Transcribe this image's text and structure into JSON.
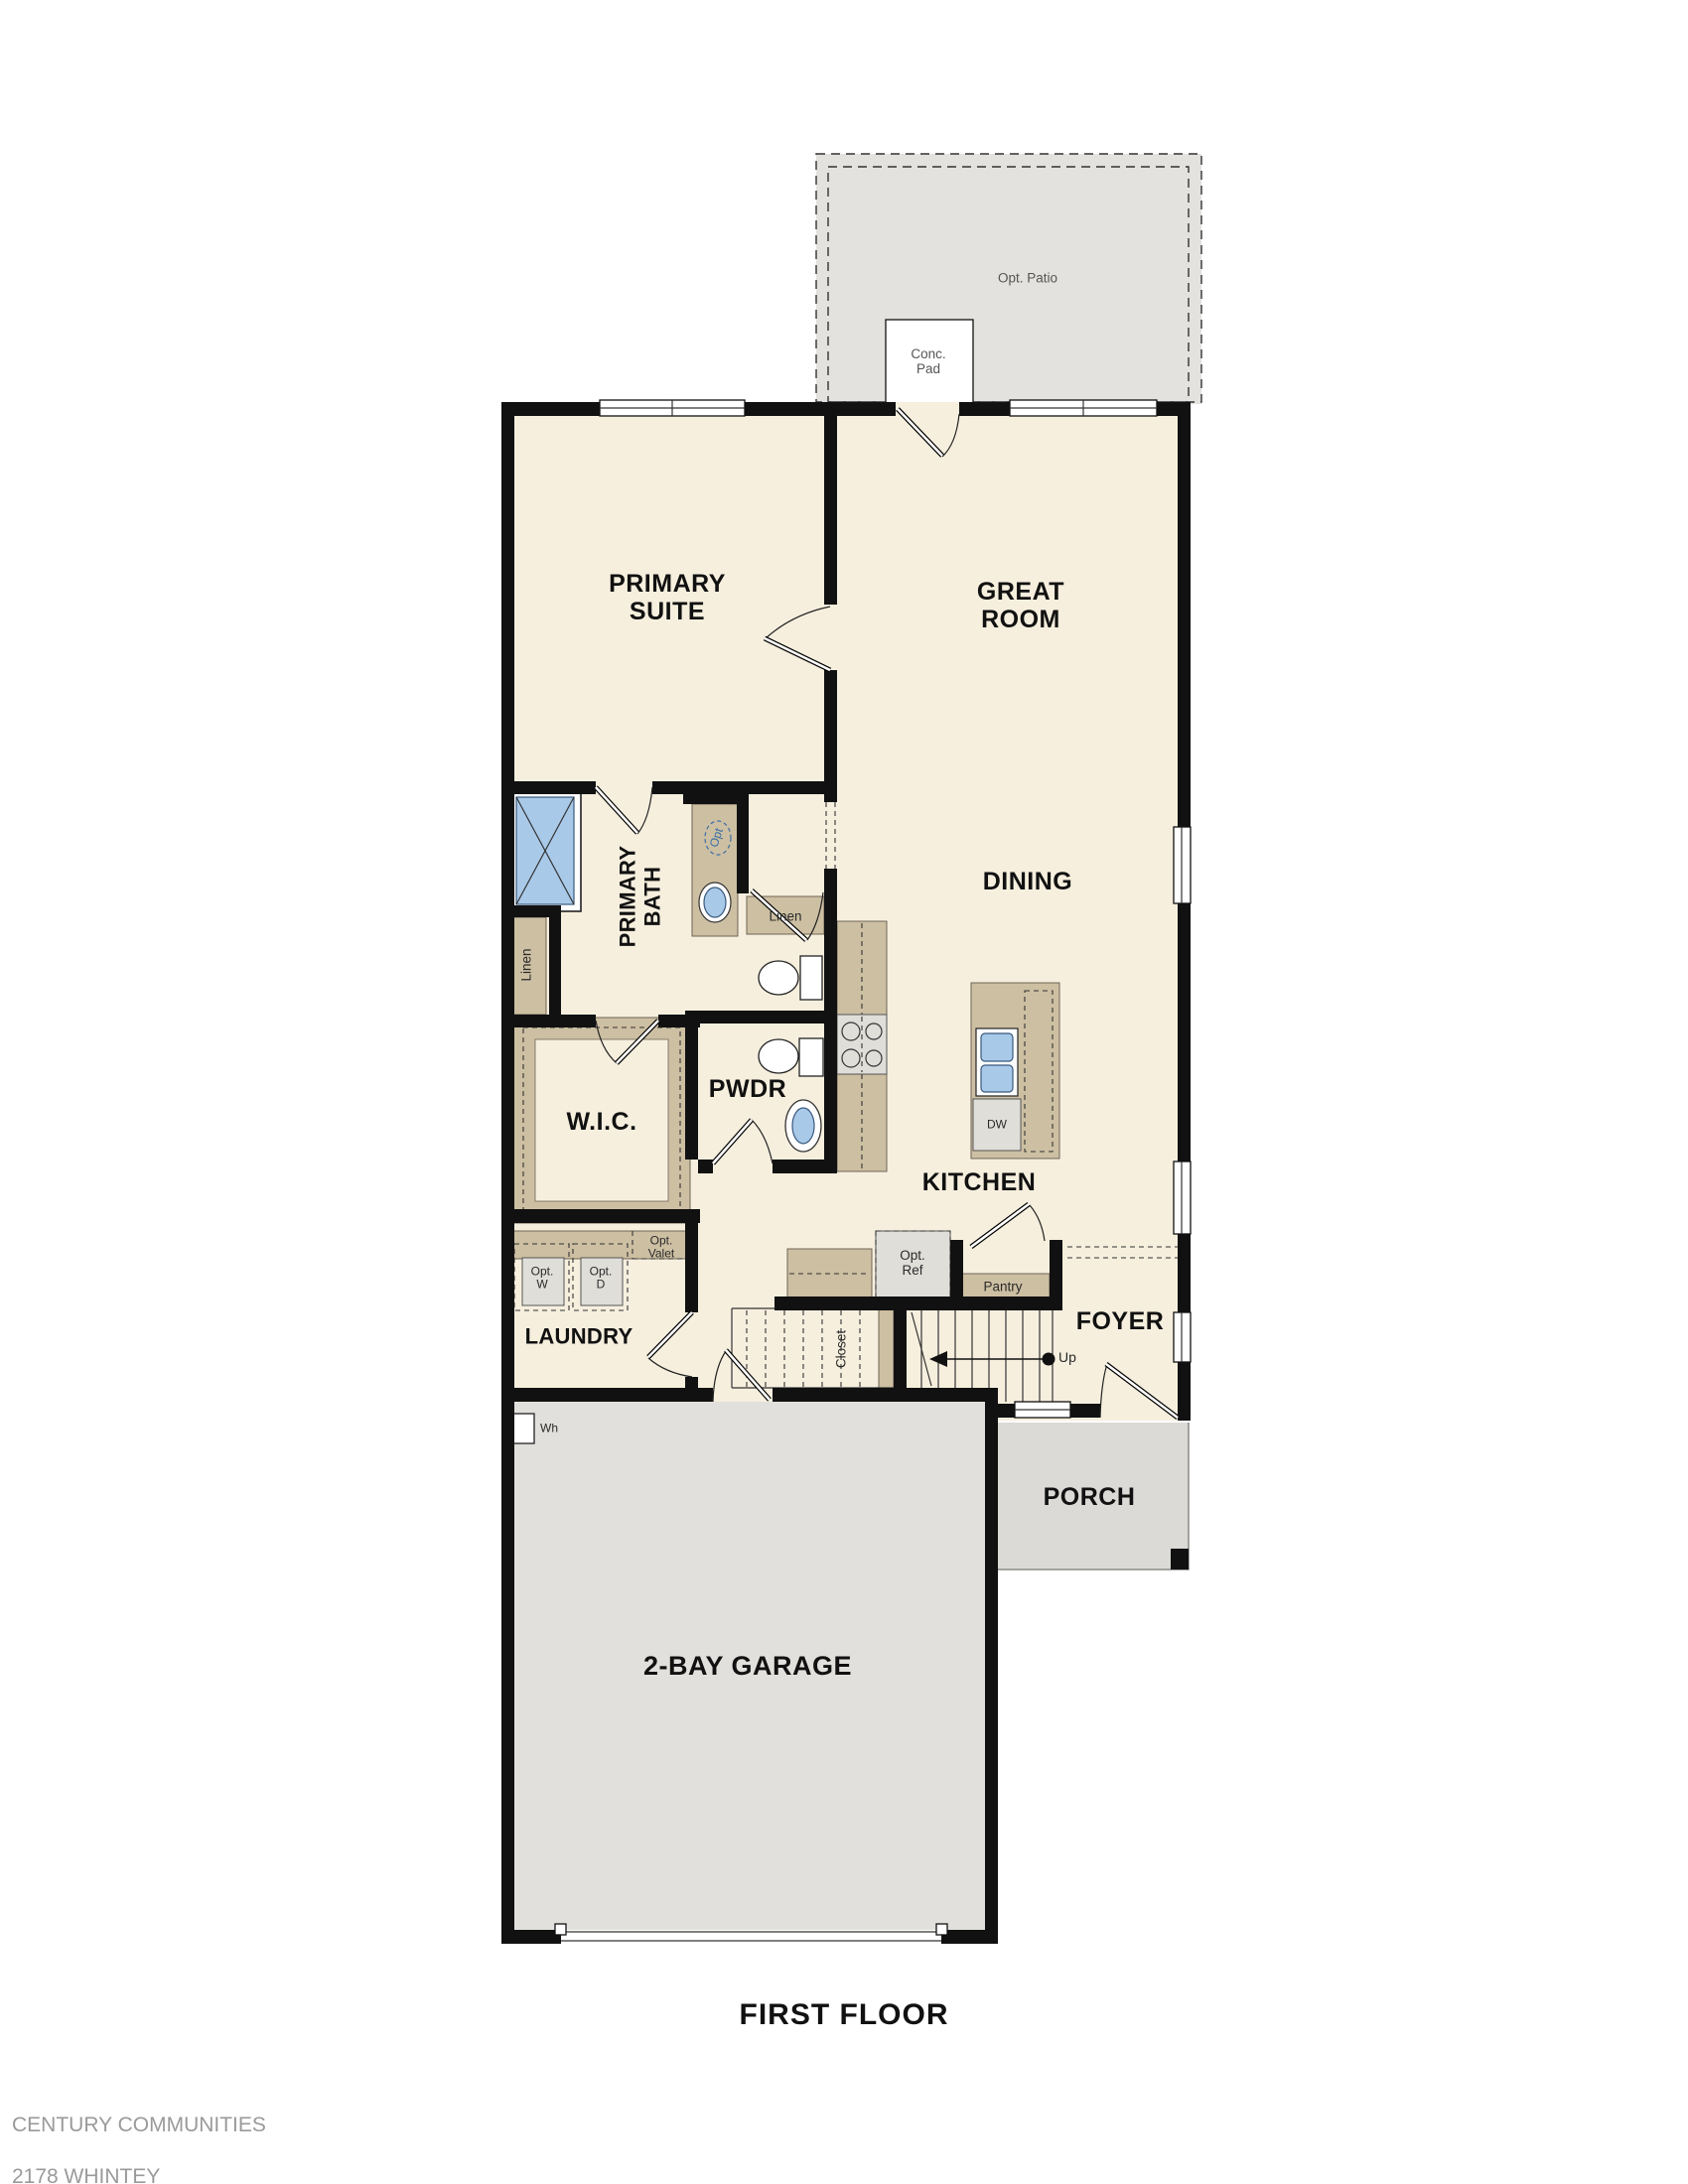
{
  "title": {
    "floor": "FIRST FLOOR"
  },
  "footer": {
    "line1": "CENTURY COMMUNITIES",
    "line2": "2178 WHINTEY",
    "line3": "REV 01.14.2021"
  },
  "rooms": {
    "primary_suite": "PRIMARY\nSUITE",
    "great_room": "GREAT\nROOM",
    "dining": "DINING",
    "primary_bath": "PRIMARY\nBATH",
    "wic": "W.I.C.",
    "pwdr": "PWDR",
    "kitchen": "KITCHEN",
    "laundry": "LAUNDRY",
    "foyer": "FOYER",
    "closet": "Closet",
    "porch": "PORCH",
    "garage": "2-BAY GARAGE"
  },
  "features": {
    "opt_patio": "Opt. Patio",
    "conc_pad": "Conc.\nPad",
    "linen_left": "Linen",
    "linen_right": "Linen",
    "opt_sink": "Opt",
    "opt_washer": "Opt.\nW",
    "opt_dryer": "Opt.\nD",
    "opt_valet": "Opt.\nValet",
    "opt_ref": "Opt.\nRef",
    "pantry": "Pantry",
    "dishwasher": "DW",
    "water_heater": "Wh",
    "stairs_up": "Up"
  },
  "colors": {
    "wall": "#111111",
    "floor": "#f6efde",
    "patio": "#e4e2de",
    "garage": "#e2e0dc",
    "porch": "#dcdad6",
    "cabinet": "#cdbfa2",
    "appliance": "#e0ded9",
    "fixture": "#a9c9e9",
    "optblue": "#3a6ea5",
    "label": "#111111",
    "muted": "#555555",
    "footer": "#9a9a9a"
  }
}
